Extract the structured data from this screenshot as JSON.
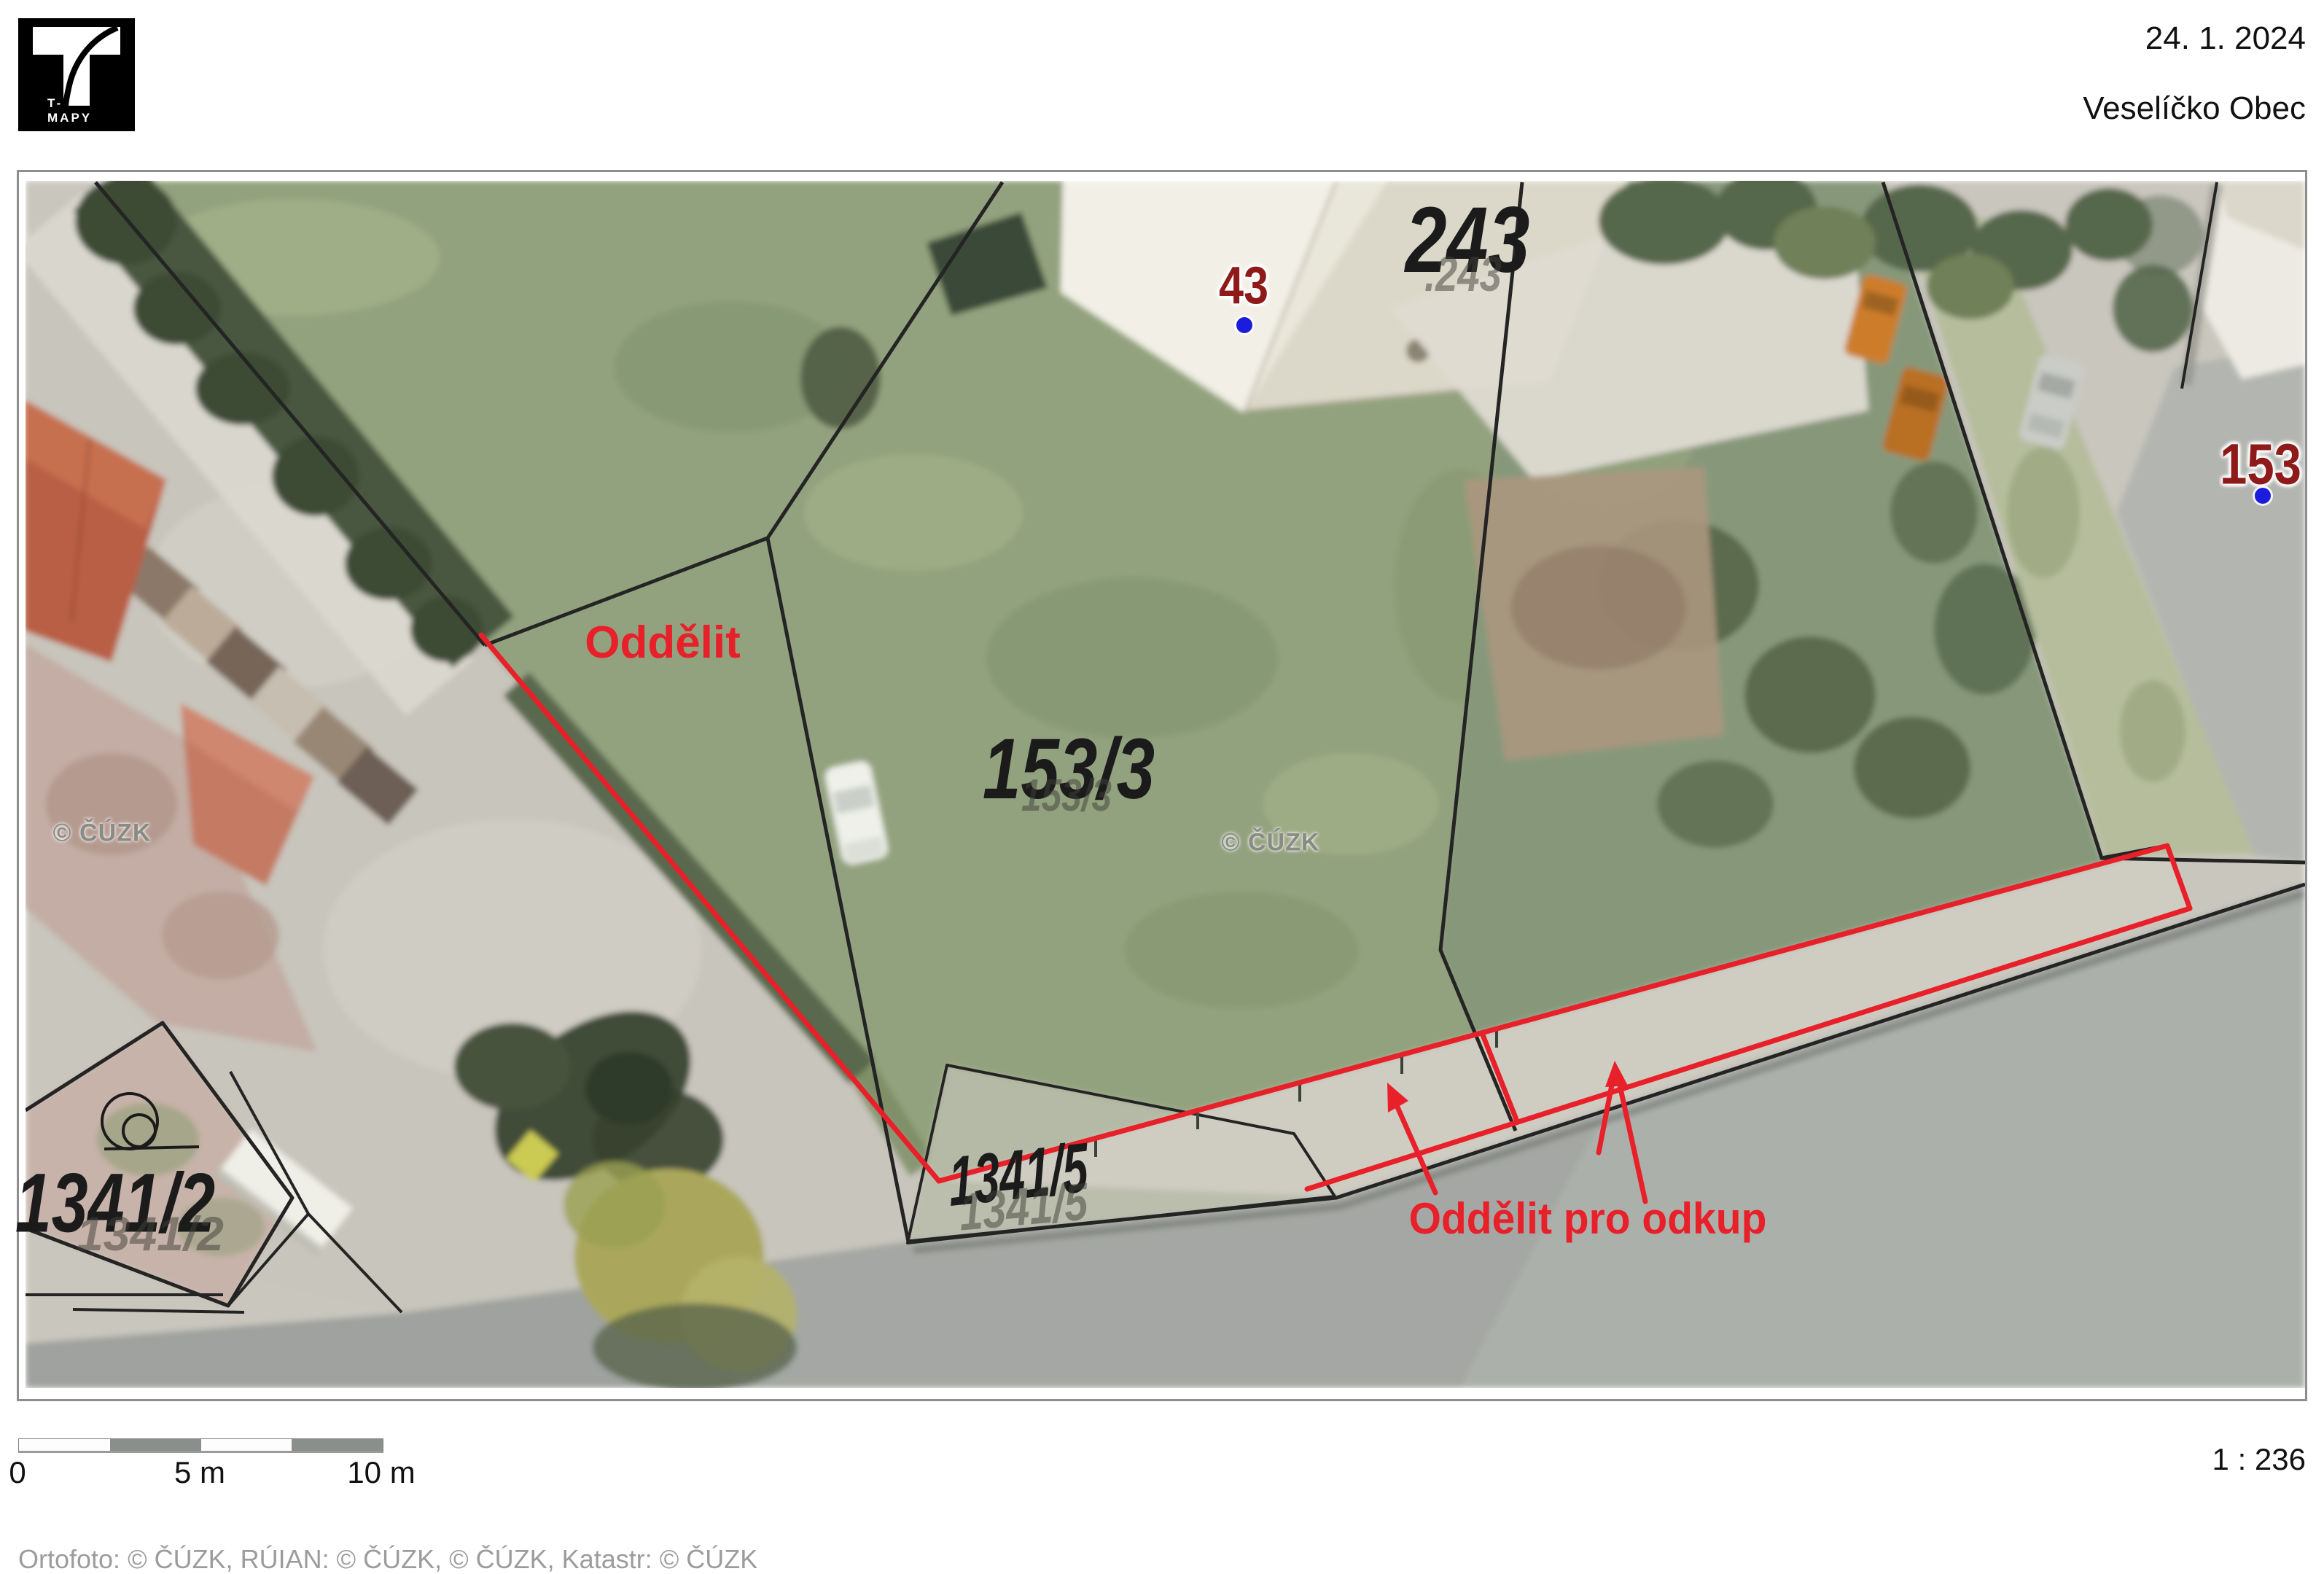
{
  "header": {
    "date": "24. 1. 2024",
    "municipality": "Veselíčko Obec",
    "logo": "T-MAPY"
  },
  "map": {
    "annotation_color": "#e8202a",
    "cadastral_line_color": "#242424",
    "annotations": {
      "separate": "Oddělit",
      "separate_for_purchase": "Oddělit pro odkup"
    },
    "parcel_labels": {
      "building_243": "243",
      "building_243_shadow": ".243",
      "house_43": "43",
      "house_153": "153",
      "parcel_153_3": "153/3",
      "parcel_153_3_shadow": "153/3",
      "parcel_1341_5": "1341/5",
      "parcel_1341_5_shadow": "1341/5",
      "parcel_1341_2": "1341/2",
      "parcel_1341_2_shadow": "1341/2"
    },
    "definition_point_color": "#1c1cdc",
    "watermark": "© ČÚZK"
  },
  "footer": {
    "scale_ratio": "1 : 236",
    "scale_bar": {
      "zero": "0",
      "five": "5 m",
      "ten": "10 m"
    },
    "attribution": "Ortofoto: © ČÚZK, RÚIAN: © ČÚZK, © ČÚZK, Katastr: © ČÚZK"
  }
}
